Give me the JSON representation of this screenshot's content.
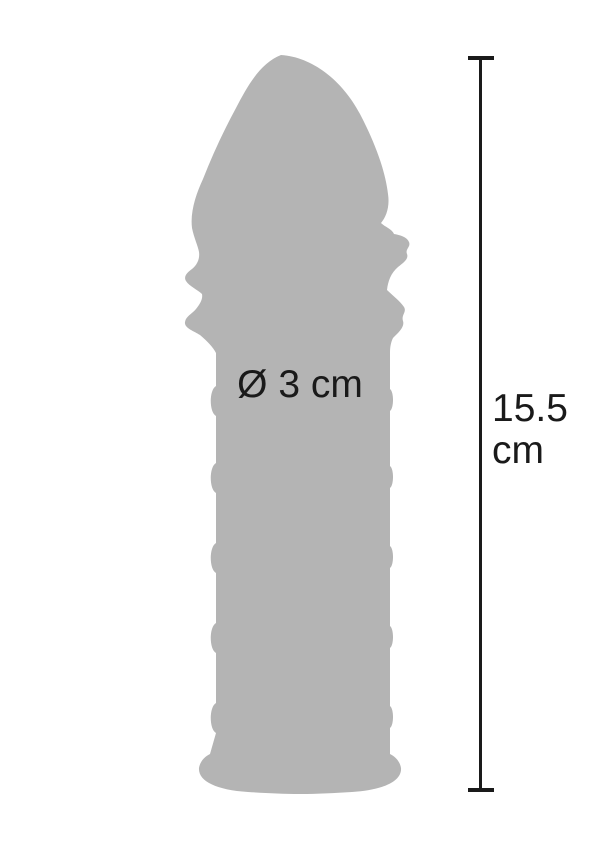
{
  "page": {
    "background_color": "#ffffff"
  },
  "product": {
    "silhouette": "textured-extension-sleeve",
    "silhouette_color": "#b4b4b4",
    "diameter_label": "Ø 3 cm"
  },
  "measurement": {
    "length_value": "15.5",
    "length_unit": "cm",
    "line_color": "#1a1a1a",
    "text_color": "#1a1a1a"
  }
}
